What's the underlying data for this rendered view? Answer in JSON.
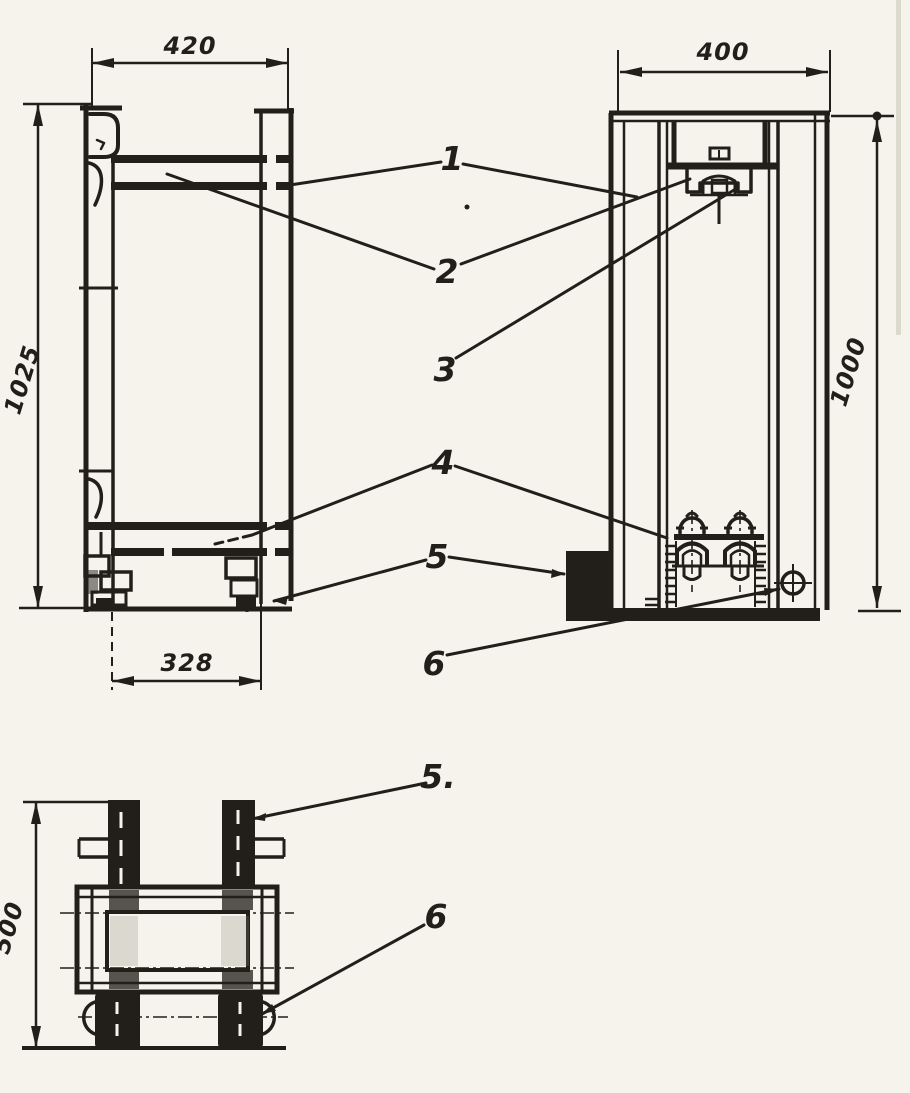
{
  "figure": {
    "kind": "scanned technical drawing, two orthographic views of a roller frame with a section view",
    "paper_color": "#f5f3ec",
    "ink_color": "#221f1a"
  },
  "dims": {
    "side_width": "420",
    "side_height": "1025",
    "side_base": "328",
    "front_width": "400",
    "front_height": "1000",
    "section_height": "500"
  },
  "callouts": {
    "main": [
      "1",
      "2",
      "3",
      "4",
      "5",
      "6"
    ],
    "section": [
      "5.",
      "6"
    ]
  }
}
